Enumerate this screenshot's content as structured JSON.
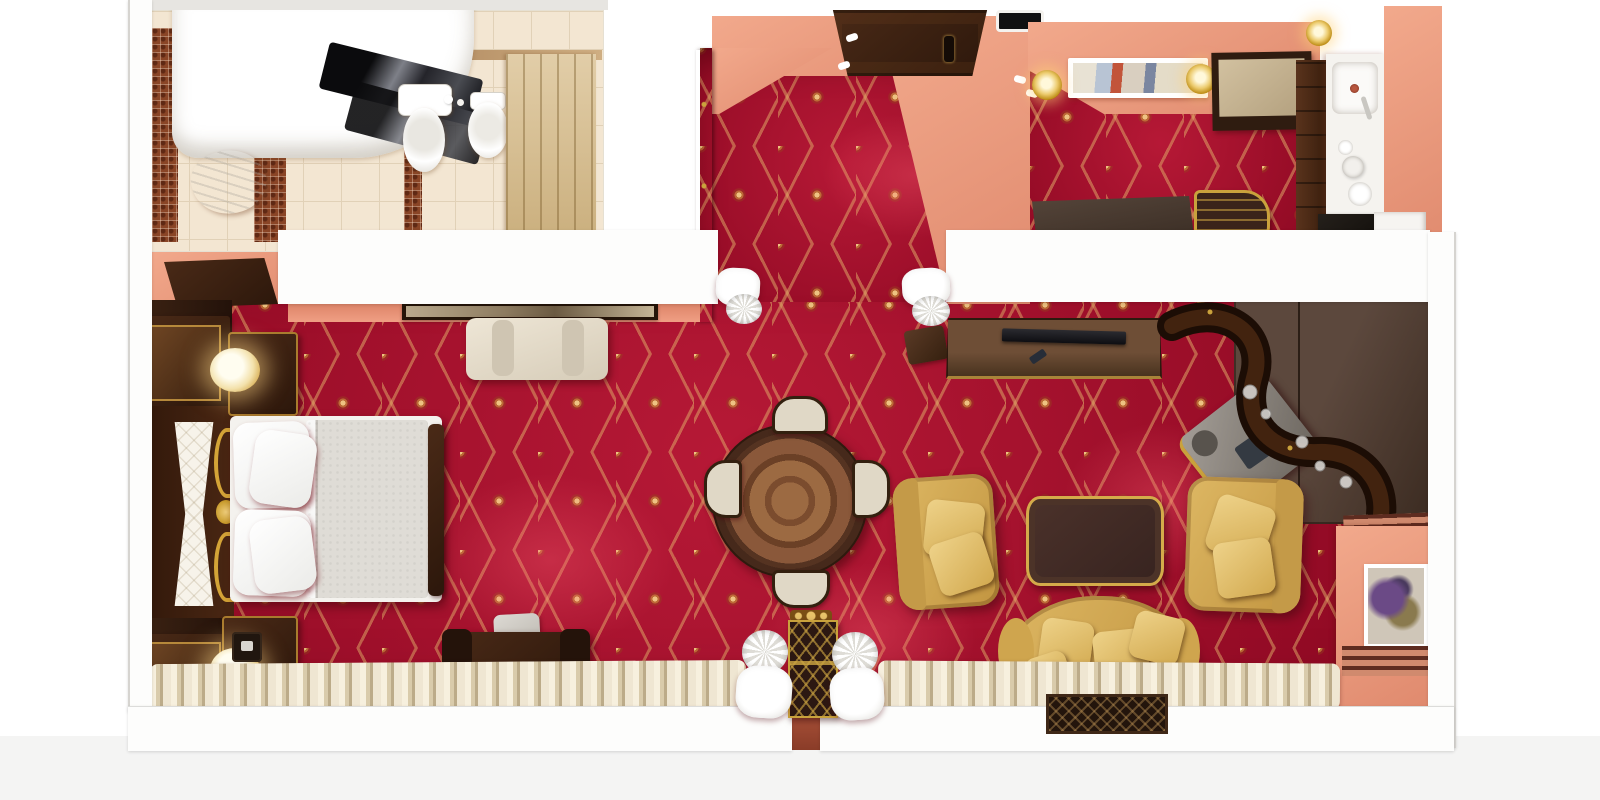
{
  "scene": {
    "type": "3d-floorplan-render",
    "subject": "luxury hotel suite, top-down cutaway view",
    "style": "classic interior with red-gold ogee carpet, salmon walls, dark wood and gilt furniture",
    "visible_text": ""
  },
  "palette": {
    "carpet_red": "#a80e2d",
    "carpet_gold": "#d8a867",
    "wall_salmon": "#ec9d82",
    "wall_white": "#fdfdfc",
    "wood_dark": "#35200f",
    "wood_mid": "#5d3a22",
    "wood_light": "#8a5a36",
    "gold": "#c9a23c",
    "cream": "#e9dfc9",
    "upholstery_yellow": "#d9b35e",
    "upholstery_gray": "#8a8580",
    "tile_cream": "#f3e6d2",
    "mosaic_brown": "#8a4526",
    "duvet_gray": "#dfdcd6",
    "glass_dark": "#1e1e22",
    "plant_green": "#3c6b34",
    "background": "#ffffff"
  },
  "rooms": {
    "bathroom": {
      "name": "bathroom",
      "items": [
        "corner bathtub",
        "dark glass screen",
        "toilet",
        "bidet",
        "toiletry bottles",
        "towel",
        "mosaic tile strips",
        "wooden door"
      ]
    },
    "entry_hall": {
      "name": "entry hall",
      "items": [
        "double entry door",
        "open door leaf",
        "ceiling vent",
        "downlights",
        "luggage desk",
        "gilt luggage rack"
      ]
    },
    "kitchenette": {
      "name": "kitchenette corner",
      "items": [
        "sink counter",
        "coffee set",
        "wardrobe",
        "minibar fridge",
        "white cabinet",
        "ceiling picture",
        "chandeliers",
        "overhead cabinet"
      ]
    },
    "bedroom": {
      "name": "bedroom",
      "items": [
        "double bed",
        "pillows",
        "duvet",
        "quilted headboard panel",
        "gold scroll ornament",
        "nightstands",
        "table lamps",
        "telephone",
        "wardrobe cabinets",
        "open bedroom door",
        "loveseat bench",
        "wall picture",
        "writing desk",
        "desk chair",
        "potted plant",
        "serving tray",
        "wall sconces",
        "window curtains"
      ]
    },
    "dining_area": {
      "name": "dining area",
      "items": [
        "round dining table",
        "four upholstered chairs"
      ]
    },
    "living_room": {
      "name": "living room",
      "items": [
        "tv console",
        "flat tv",
        "remote control",
        "side stool",
        "two yellow armchairs",
        "coffee table",
        "yellow sofa",
        "sofa pillows",
        "serpentine bar cabinet",
        "bar glasses",
        "gray chaise chair",
        "bar back cabinet",
        "wall painting",
        "louver panels",
        "window curtains",
        "floor grille"
      ]
    },
    "hallway": {
      "name": "hallway with columns",
      "items": [
        "four white columns",
        "ornate lattice console table"
      ]
    }
  },
  "counts": {
    "columns": 4,
    "dining_chairs": 4,
    "bed_pillow_stacks": 2,
    "sofa_pillows": 4,
    "armchairs": 2,
    "table_lamps": 2,
    "chandeliers": 3,
    "wall_pictures": 3
  }
}
